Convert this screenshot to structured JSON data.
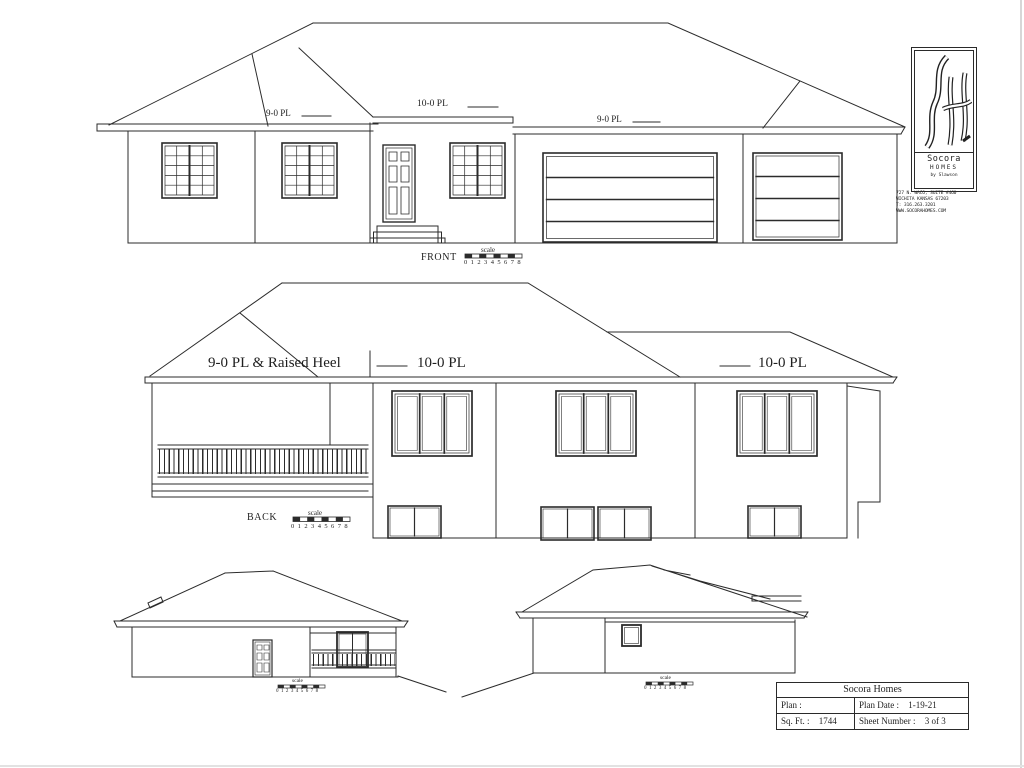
{
  "drawing": {
    "line_color": "#2b2b2b",
    "bg_color": "#ffffff"
  },
  "front": {
    "title": "FRONT",
    "plate_left": "9-0 PL",
    "plate_center": "10-0 PL",
    "plate_right": "9-0 PL"
  },
  "back": {
    "title": "BACK",
    "plate_left": "9-0 PL & Raised Heel",
    "plate_center": "10-0 PL",
    "plate_right": "10-0 PL"
  },
  "scale_bar": {
    "label": "scale",
    "numbers": "0 1 2 3 4 5 6 7 8"
  },
  "logo": {
    "monogram": "SH",
    "name": "Socora",
    "type": "HOMES",
    "byline": "by Slawson",
    "address_lines": [
      "727 N. WACO, SUITE #460",
      "WICHITA KANSAS 67203",
      "T: 316.263.3201",
      "WWW.SOCORAHOMES.COM"
    ]
  },
  "title_block": {
    "company": "Socora Homes",
    "plan_label": "Plan :",
    "plan_value": "",
    "date_label": "Plan Date :",
    "date_value": "1-19-21",
    "sqft_label": "Sq. Ft. :",
    "sqft_value": "1744",
    "sheet_label": "Sheet Number :",
    "sheet_value": "3 of 3"
  }
}
